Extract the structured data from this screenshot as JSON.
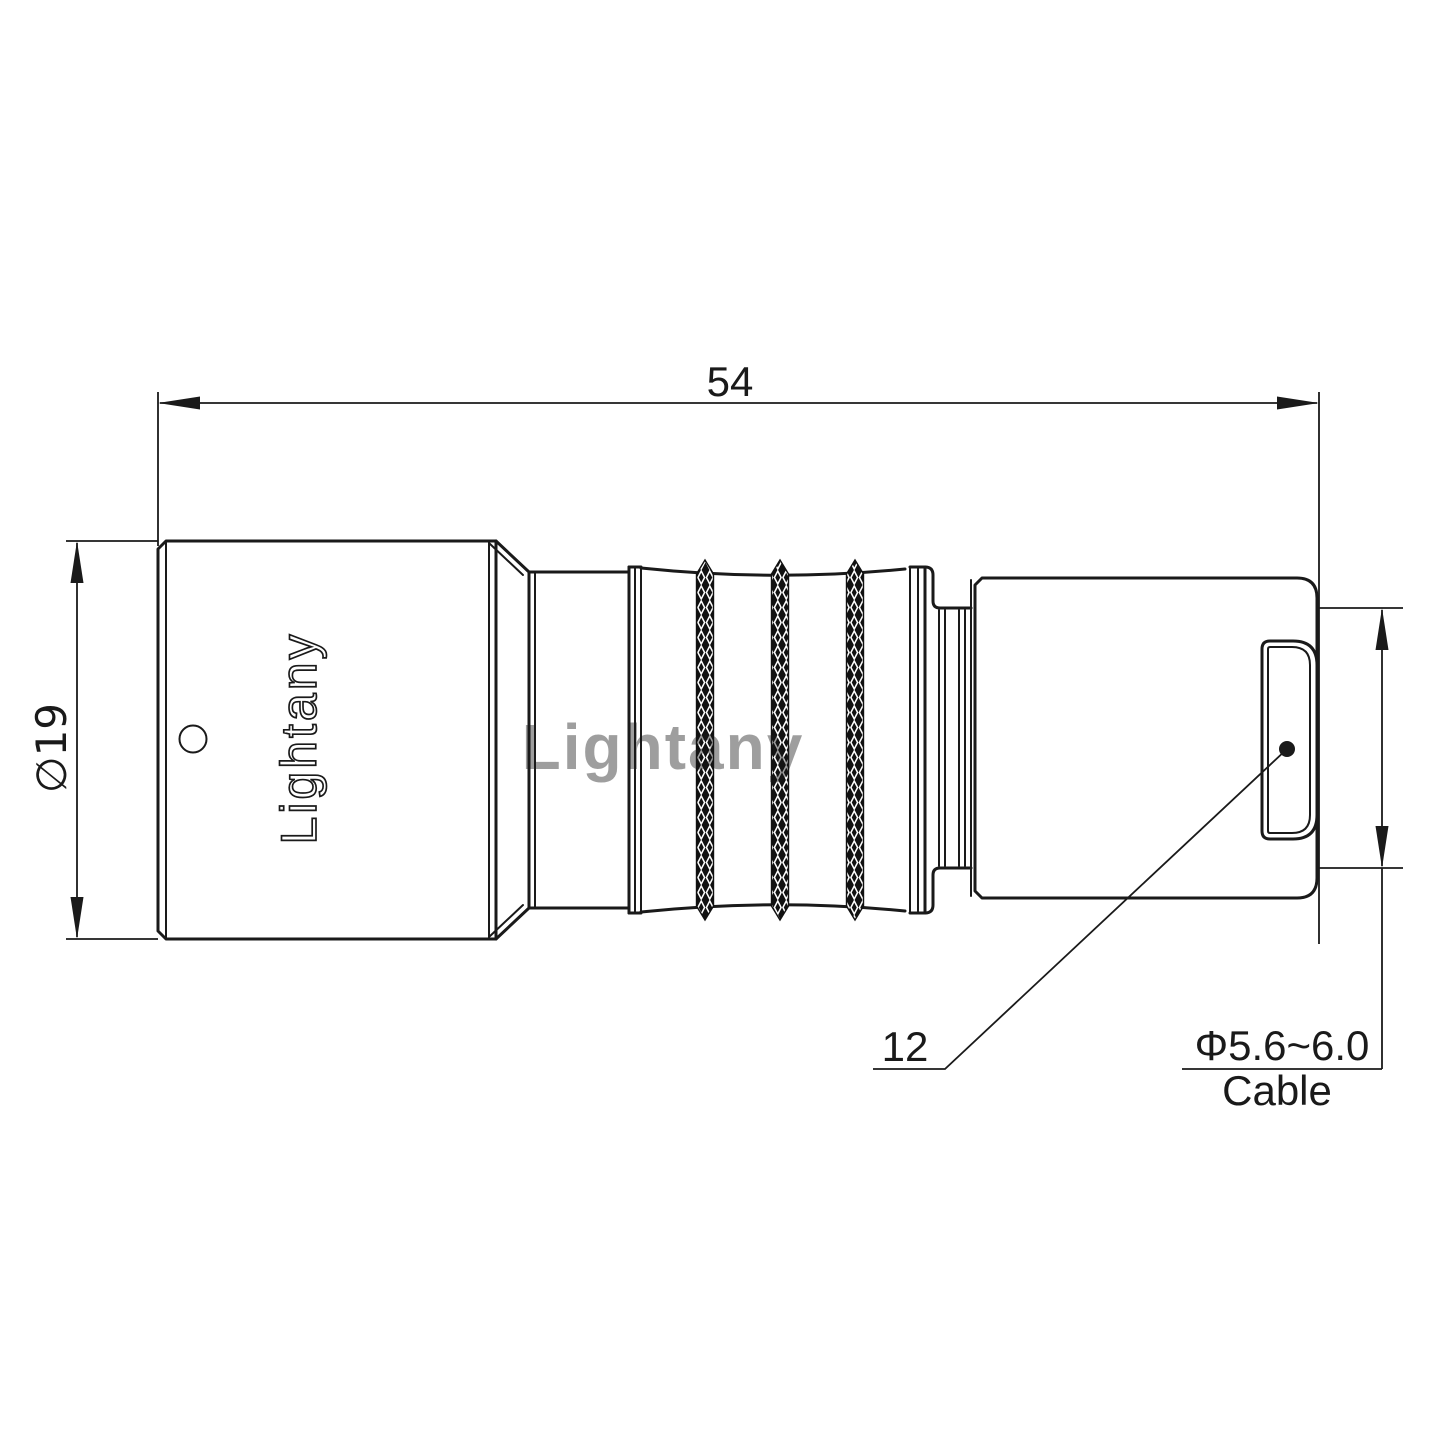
{
  "drawing": {
    "type": "connector-technical-drawing",
    "watermark": {
      "text": "Lightany",
      "color": "#e07a7a"
    },
    "part": {
      "engraving": "Lightany"
    },
    "dimensions": {
      "overall_length": "54",
      "body_diameter": "∅19",
      "nut_leader": "12",
      "cable_diameter": "Φ5.6~6.0",
      "cable_label": "Cable"
    },
    "colors": {
      "line": "#1a1a1a",
      "background": "#ffffff"
    }
  }
}
